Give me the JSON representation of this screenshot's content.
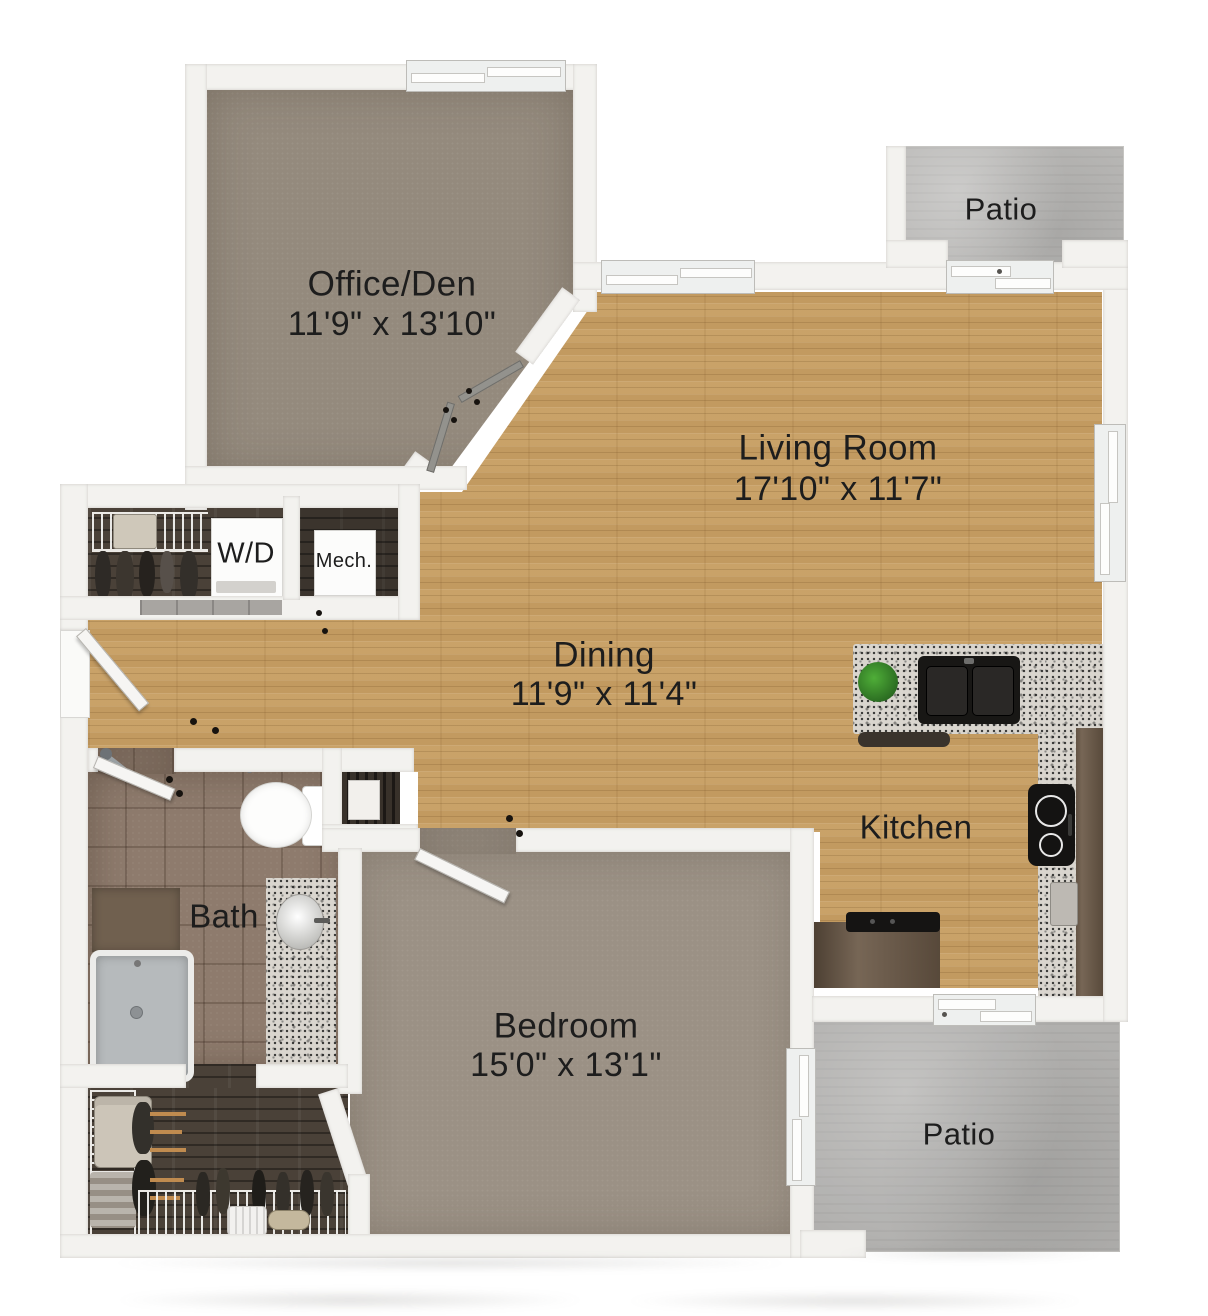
{
  "rooms": {
    "office": {
      "name": "Office/Den",
      "dims": "11'9\" x 13'10\""
    },
    "living": {
      "name": "Living Room",
      "dims": "17'10\" x 11'7\""
    },
    "dining": {
      "name": "Dining",
      "dims": "11'9\" x 11'4\""
    },
    "kitchen": {
      "name": "Kitchen"
    },
    "bath": {
      "name": "Bath"
    },
    "bedroom": {
      "name": "Bedroom",
      "dims": "15'0\" x 13'1\""
    },
    "patio_top": {
      "name": "Patio"
    },
    "patio_bottom": {
      "name": "Patio"
    }
  },
  "closets": {
    "washer_dryer": "W/D",
    "mechanical": "Mech."
  },
  "colors": {
    "hardwood": "#c69f66",
    "office_carpet": "#948a7d",
    "bedroom_carpet": "#9b9185",
    "bath_tile": "#8e7b6d",
    "concrete_patio": "#b8b7b5",
    "granite_counter": "#d9d5ce",
    "dark_cabinet": "#6b5947",
    "closet_floor": "#4a4138",
    "wall": "#f3f2ef",
    "label_text": "#1d1d1d"
  }
}
